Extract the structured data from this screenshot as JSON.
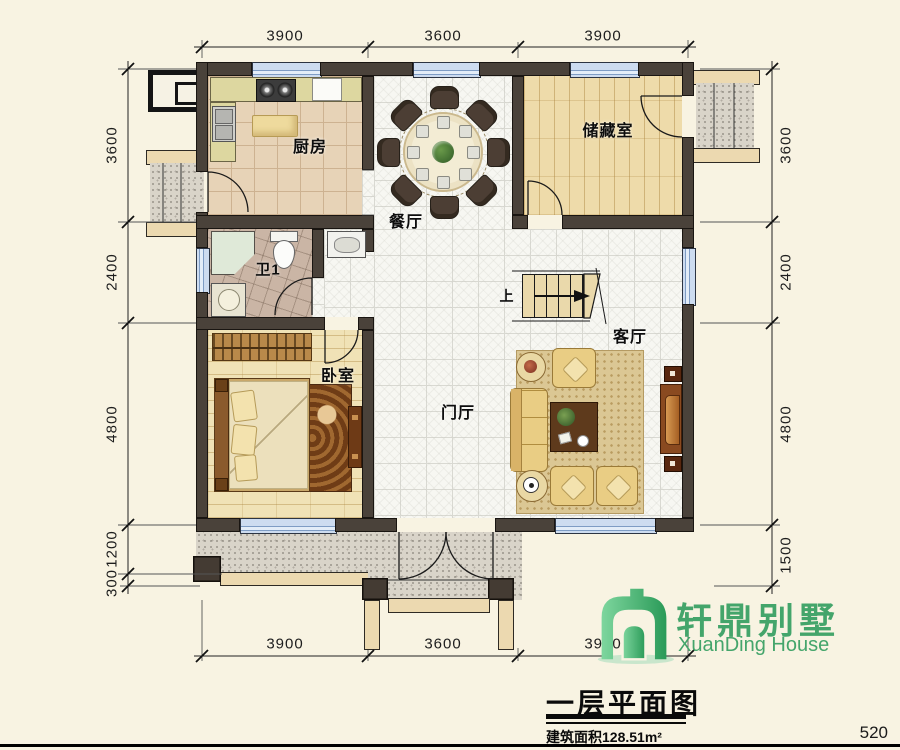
{
  "dims": {
    "top": [
      "3900",
      "3600",
      "3900"
    ],
    "bottom": [
      "3900",
      "3600",
      "3900"
    ],
    "left": [
      "3600",
      "2400",
      "4800",
      "1200",
      "300"
    ],
    "right": [
      "3600",
      "2400",
      "4800",
      "1500"
    ]
  },
  "rooms": {
    "kitchen": "厨房",
    "dining": "餐厅",
    "storage": "储藏室",
    "bath": "卫1",
    "bedroom": "卧室",
    "hall": "门厅",
    "living": "客厅"
  },
  "stairs": {
    "up": "上"
  },
  "logo": {
    "cn": "轩鼎别墅",
    "en": "XuanDing House",
    "accent": "#44a56b"
  },
  "title_block": {
    "title": "一层平面图",
    "area": "建筑面积128.51m²",
    "sheet": "520"
  },
  "colors": {
    "wall": "#4a423a",
    "window": "#cddcf0",
    "paper": "#f8f3e2"
  }
}
